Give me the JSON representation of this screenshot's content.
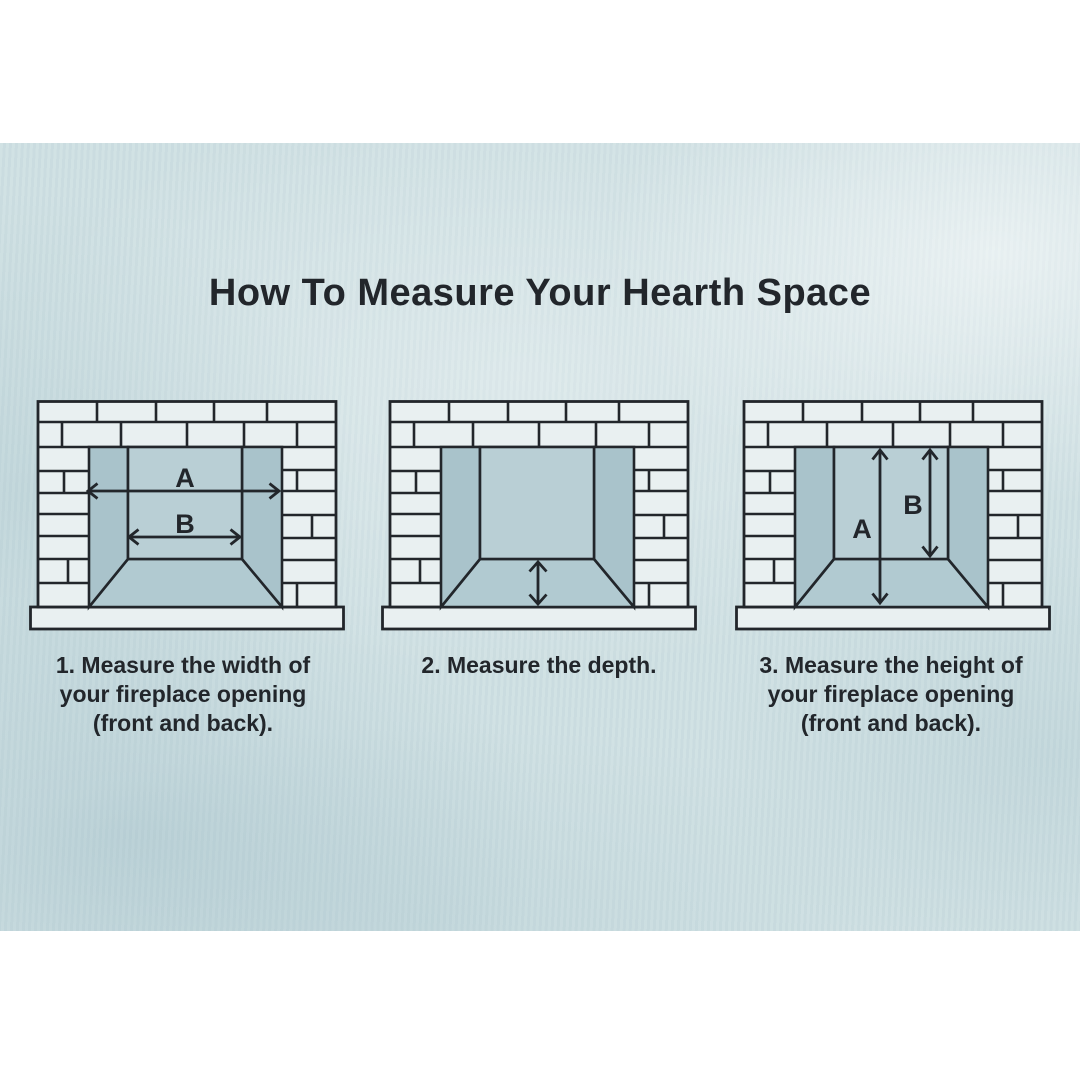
{
  "title": "How To Measure Your Hearth Space",
  "diagrams": [
    {
      "name": "measure-width",
      "labels": {
        "a": "A",
        "b": "B"
      },
      "caption_lines": [
        "1. Measure the width of",
        "your fireplace opening",
        "(front and back)."
      ]
    },
    {
      "name": "measure-depth",
      "caption_lines": [
        "2. Measure the depth."
      ]
    },
    {
      "name": "measure-height",
      "labels": {
        "a": "A",
        "b": "B"
      },
      "caption_lines": [
        "3. Measure the height of",
        "your fireplace opening",
        "(front and back)."
      ]
    }
  ],
  "colors": {
    "canvas": "#ffffff",
    "wash": "#cfe0e3",
    "ink": "#22262b",
    "brick": "#e9f0f1",
    "wall_side": "#a9c3cb",
    "wall_back": "#b9cfd5",
    "floor": "#b1cad1"
  }
}
